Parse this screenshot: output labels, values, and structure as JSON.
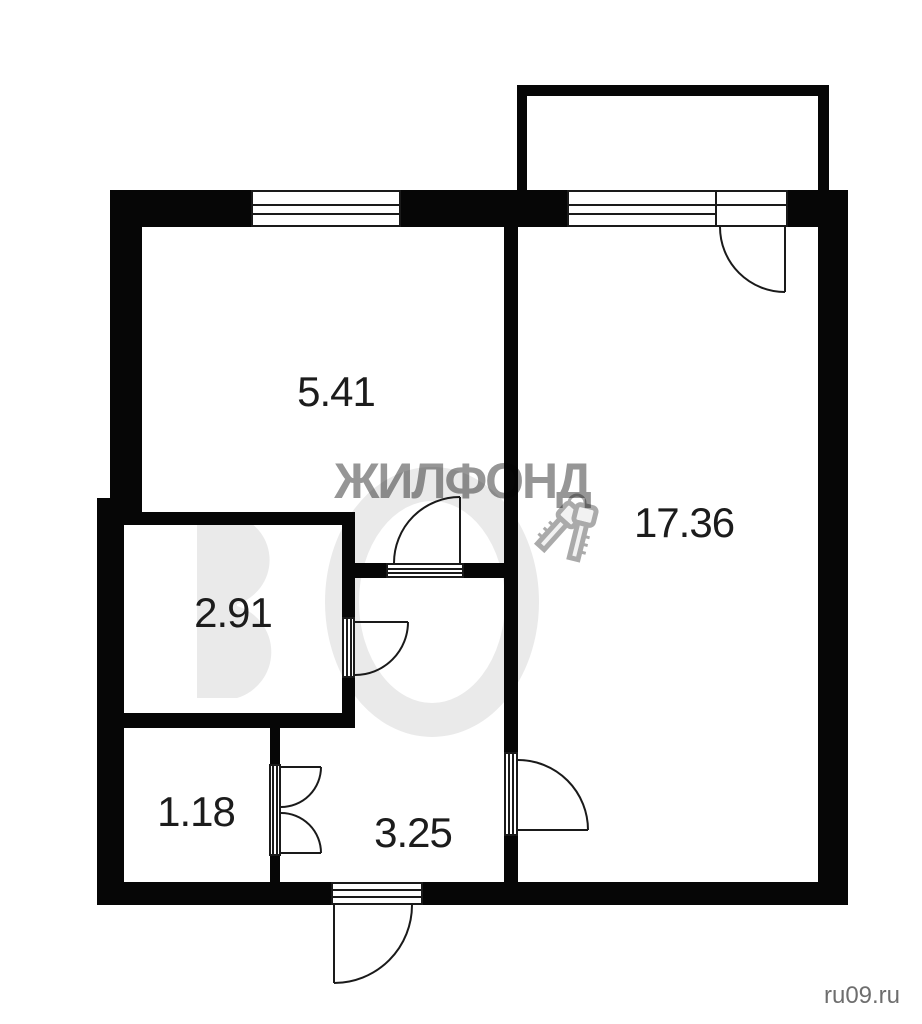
{
  "plan": {
    "type": "apartment-floor-plan",
    "rooms": [
      {
        "id": "room-top-left",
        "area_label": "5.41"
      },
      {
        "id": "room-right",
        "area_label": "17.36"
      },
      {
        "id": "storage",
        "area_label": "2.91"
      },
      {
        "id": "bathroom",
        "area_label": "1.18"
      },
      {
        "id": "hallway",
        "area_label": "3.25"
      }
    ],
    "features": [
      "balcony",
      "windows",
      "door-swings",
      "entrance-door"
    ]
  },
  "watermark": {
    "brand": "ЖИЛФОНД",
    "icon": "keys-icon",
    "site": "ru09.ru"
  },
  "colors": {
    "wall": "#060606",
    "line": "#1a1a1a",
    "label": "#1c1c1c",
    "watermark": "#969696",
    "site": "#6e6e6e",
    "faint": "#eaeaea",
    "bg": "#ffffff"
  }
}
